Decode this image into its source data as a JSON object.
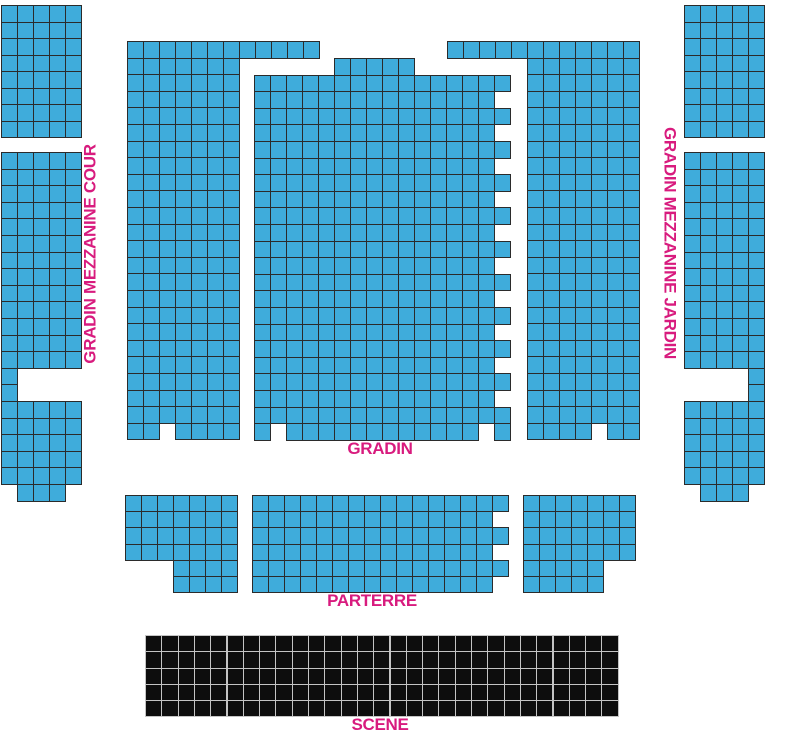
{
  "canvas": {
    "width": 797,
    "height": 748,
    "background": "#FFFFFF"
  },
  "colors": {
    "seat_fill": "#3FACDB",
    "seat_border": "#2B2B2B",
    "stage_fill": "#0D0D0D",
    "stage_border": "#C4C4C4",
    "label_pink": "#D81B7E"
  },
  "labels": {
    "mezzanine_cour": "GRADIN MEZZANINE COUR",
    "mezzanine_jardin": "GRADIN MEZZANINE JARDIN",
    "gradin": "GRADIN",
    "parterre": "PARTERRE",
    "scene": "SCENE"
  },
  "blocks": [
    {
      "id": "mezzanine-cour-upper",
      "kind": "seats",
      "x": 1,
      "y": 5,
      "cell_w": 16,
      "cell_h": 16.5,
      "rows": [
        "11111",
        "11111",
        "11111",
        "11111",
        "11111",
        "11111",
        "11111",
        "11111"
      ]
    },
    {
      "id": "mezzanine-cour-lower",
      "kind": "seats",
      "x": 1,
      "y": 152,
      "cell_w": 16,
      "cell_h": 16.6,
      "rows": [
        "11111",
        "11111",
        "11111",
        "11111",
        "11111",
        "11111",
        "11111",
        "11111",
        "11111",
        "11111",
        "11111",
        "11111",
        "11111",
        "10000",
        "10000",
        "11111",
        "11111",
        "11111",
        "11111",
        "11111",
        "01110"
      ]
    },
    {
      "id": "mezzanine-jardin-upper",
      "kind": "seats",
      "x": 684,
      "y": 5,
      "cell_w": 16,
      "cell_h": 16.5,
      "rows": [
        "11111",
        "11111",
        "11111",
        "11111",
        "11111",
        "11111",
        "11111",
        "11111"
      ]
    },
    {
      "id": "mezzanine-jardin-lower",
      "kind": "seats",
      "x": 684,
      "y": 152,
      "cell_w": 16,
      "cell_h": 16.6,
      "rows": [
        "11111",
        "11111",
        "11111",
        "11111",
        "11111",
        "11111",
        "11111",
        "11111",
        "11111",
        "11111",
        "11111",
        "11111",
        "11111",
        "00001",
        "00001",
        "11111",
        "11111",
        "11111",
        "11111",
        "11111",
        "01110"
      ]
    },
    {
      "id": "gradin-left-wing",
      "kind": "seats",
      "x": 127,
      "y": 41,
      "cell_w": 16,
      "cell_h": 16.6,
      "rows": [
        "111111111111",
        "111111100000",
        "111111100000",
        "111111100000",
        "111111100000",
        "111111100000",
        "111111100000",
        "111111100000",
        "111111100000",
        "111111100000",
        "111111100000",
        "111111100000",
        "111111100000",
        "111111100000",
        "111111100000",
        "111111100000",
        "111111100000",
        "111111100000",
        "111111100000",
        "111111100000",
        "111111100000",
        "111111100000",
        "111111100000",
        "110111100000"
      ]
    },
    {
      "id": "gradin-center",
      "kind": "seats",
      "x": 254,
      "y": 58,
      "cell_w": 16,
      "cell_h": 16.6,
      "rows": [
        "0000011111000000",
        "1111111111111111",
        "1111111111111110",
        "1111111111111111",
        "1111111111111110",
        "1111111111111111",
        "1111111111111110",
        "1111111111111111",
        "1111111111111110",
        "1111111111111111",
        "1111111111111110",
        "1111111111111111",
        "1111111111111110",
        "1111111111111111",
        "1111111111111110",
        "1111111111111111",
        "1111111111111110",
        "1111111111111111",
        "1111111111111110",
        "1111111111111111",
        "1111111111111110",
        "1111111111111111",
        "1011111111111101"
      ]
    },
    {
      "id": "gradin-right-wing",
      "kind": "seats",
      "x": 447,
      "y": 41,
      "cell_w": 16,
      "cell_h": 16.6,
      "rows": [
        "111111111111",
        "000001111111",
        "000001111111",
        "000001111111",
        "000001111111",
        "000001111111",
        "000001111111",
        "000001111111",
        "000001111111",
        "000001111111",
        "000001111111",
        "000001111111",
        "000001111111",
        "000001111111",
        "000001111111",
        "000001111111",
        "000001111111",
        "000001111111",
        "000001111111",
        "000001111111",
        "000001111111",
        "000001111111",
        "000001111111",
        "000001111011"
      ]
    },
    {
      "id": "parterre-left",
      "kind": "seats",
      "x": 125,
      "y": 495,
      "cell_w": 16,
      "cell_h": 16.2,
      "rows": [
        "1111111",
        "1111111",
        "1111111",
        "1111111",
        "0001111",
        "0001111"
      ]
    },
    {
      "id": "parterre-center",
      "kind": "seats",
      "x": 252,
      "y": 495,
      "cell_w": 16,
      "cell_h": 16.2,
      "rows": [
        "1111111111111111",
        "1111111111111110",
        "1111111111111111",
        "1111111111111110",
        "1111111111111111",
        "1111111111111110"
      ]
    },
    {
      "id": "parterre-right",
      "kind": "seats",
      "x": 523,
      "y": 495,
      "cell_w": 16,
      "cell_h": 16.2,
      "rows": [
        "1111111",
        "1111111",
        "1111111",
        "1111111",
        "1111100",
        "1111100"
      ]
    },
    {
      "id": "scene-stage",
      "kind": "stage",
      "x": 145,
      "y": 635,
      "cell_w": 16.3,
      "cell_h": 16.3,
      "rows": [
        "11111111111111111111111111111",
        "11111111111111111111111111111",
        "11111111111111111111111111111",
        "11111111111111111111111111111",
        "11111111111111111111111111111"
      ]
    }
  ]
}
